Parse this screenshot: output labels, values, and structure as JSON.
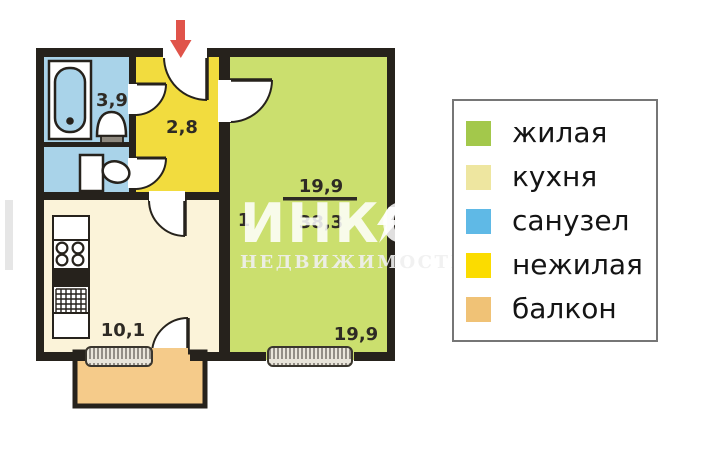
{
  "plan": {
    "rooms_count": "1",
    "living_area": "19,9",
    "total_area": "38,3",
    "room_labels": {
      "bathroom_area": "3,9",
      "hallway_area": "2,8",
      "kitchen_area": "10,1",
      "living_room_area": "19,9"
    },
    "colors": {
      "living": "#cbdf6e",
      "kitchen": "#fbf3d9",
      "sanitary": "#a9d3e9",
      "hallway": "#f2dc3e",
      "balcony": "#f5cb8a",
      "arrow": "#e0544a"
    }
  },
  "watermark": {
    "brand": "ИНКОМ",
    "subtitle": "НЕДВИЖИМОСТЬ"
  },
  "legend": {
    "items": [
      {
        "label": "жилая",
        "color": "#a3c84b"
      },
      {
        "label": "кухня",
        "color": "#eee6a0"
      },
      {
        "label": "санузел",
        "color": "#5fb9e6"
      },
      {
        "label": "нежилая",
        "color": "#fbdc00"
      },
      {
        "label": "балкон",
        "color": "#f0c276"
      }
    ]
  }
}
